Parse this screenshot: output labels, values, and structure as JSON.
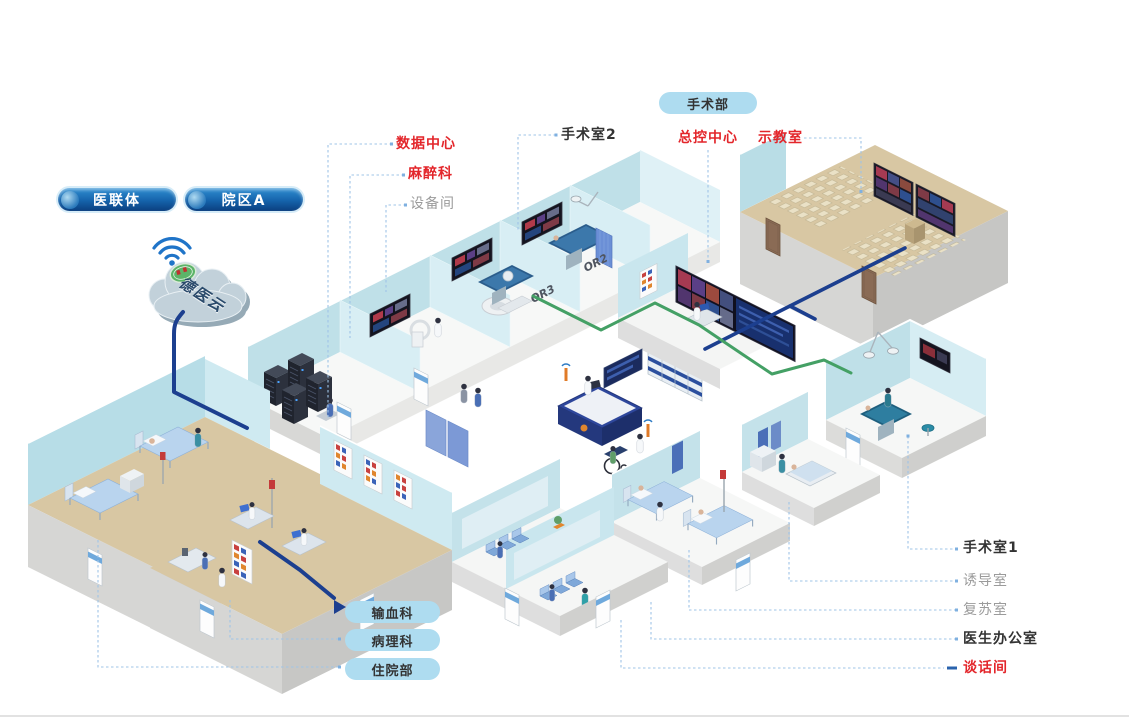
{
  "pills": {
    "alliance": "医联体",
    "campus_a": "院区A",
    "surgery_dept": "手术部",
    "blood": "输血科",
    "pathology": "病理科",
    "inpatient": "住院部"
  },
  "cloud": {
    "name": "德医云"
  },
  "labels": {
    "data_center": "数据中心",
    "anesthesia": "麻醉科",
    "equipment": "设备间",
    "or2": "手术室2",
    "master_control": "总控中心",
    "demo_room": "示教室",
    "or1": "手术室1",
    "induction": "诱导室",
    "recovery": "复苏室",
    "doctor_office": "医生办公室",
    "talk_room": "谈话间"
  },
  "wall_tags": {
    "or2": "OR2",
    "or3": "OR3"
  },
  "colors": {
    "red_label": "#e3262b",
    "dark_label": "#333333",
    "gray_label": "#9b9b9b",
    "pill_light_bg": "#aedcf0",
    "pill_dark_top": "#2f8fd2",
    "pill_dark_bottom": "#0b3f80",
    "connector": "#9fc4e7",
    "cable_blue": "#1c3f8f",
    "cable_green": "#44a065",
    "wall_blue": "#bfe0e8",
    "floor_tan": "#d8c7a3"
  }
}
